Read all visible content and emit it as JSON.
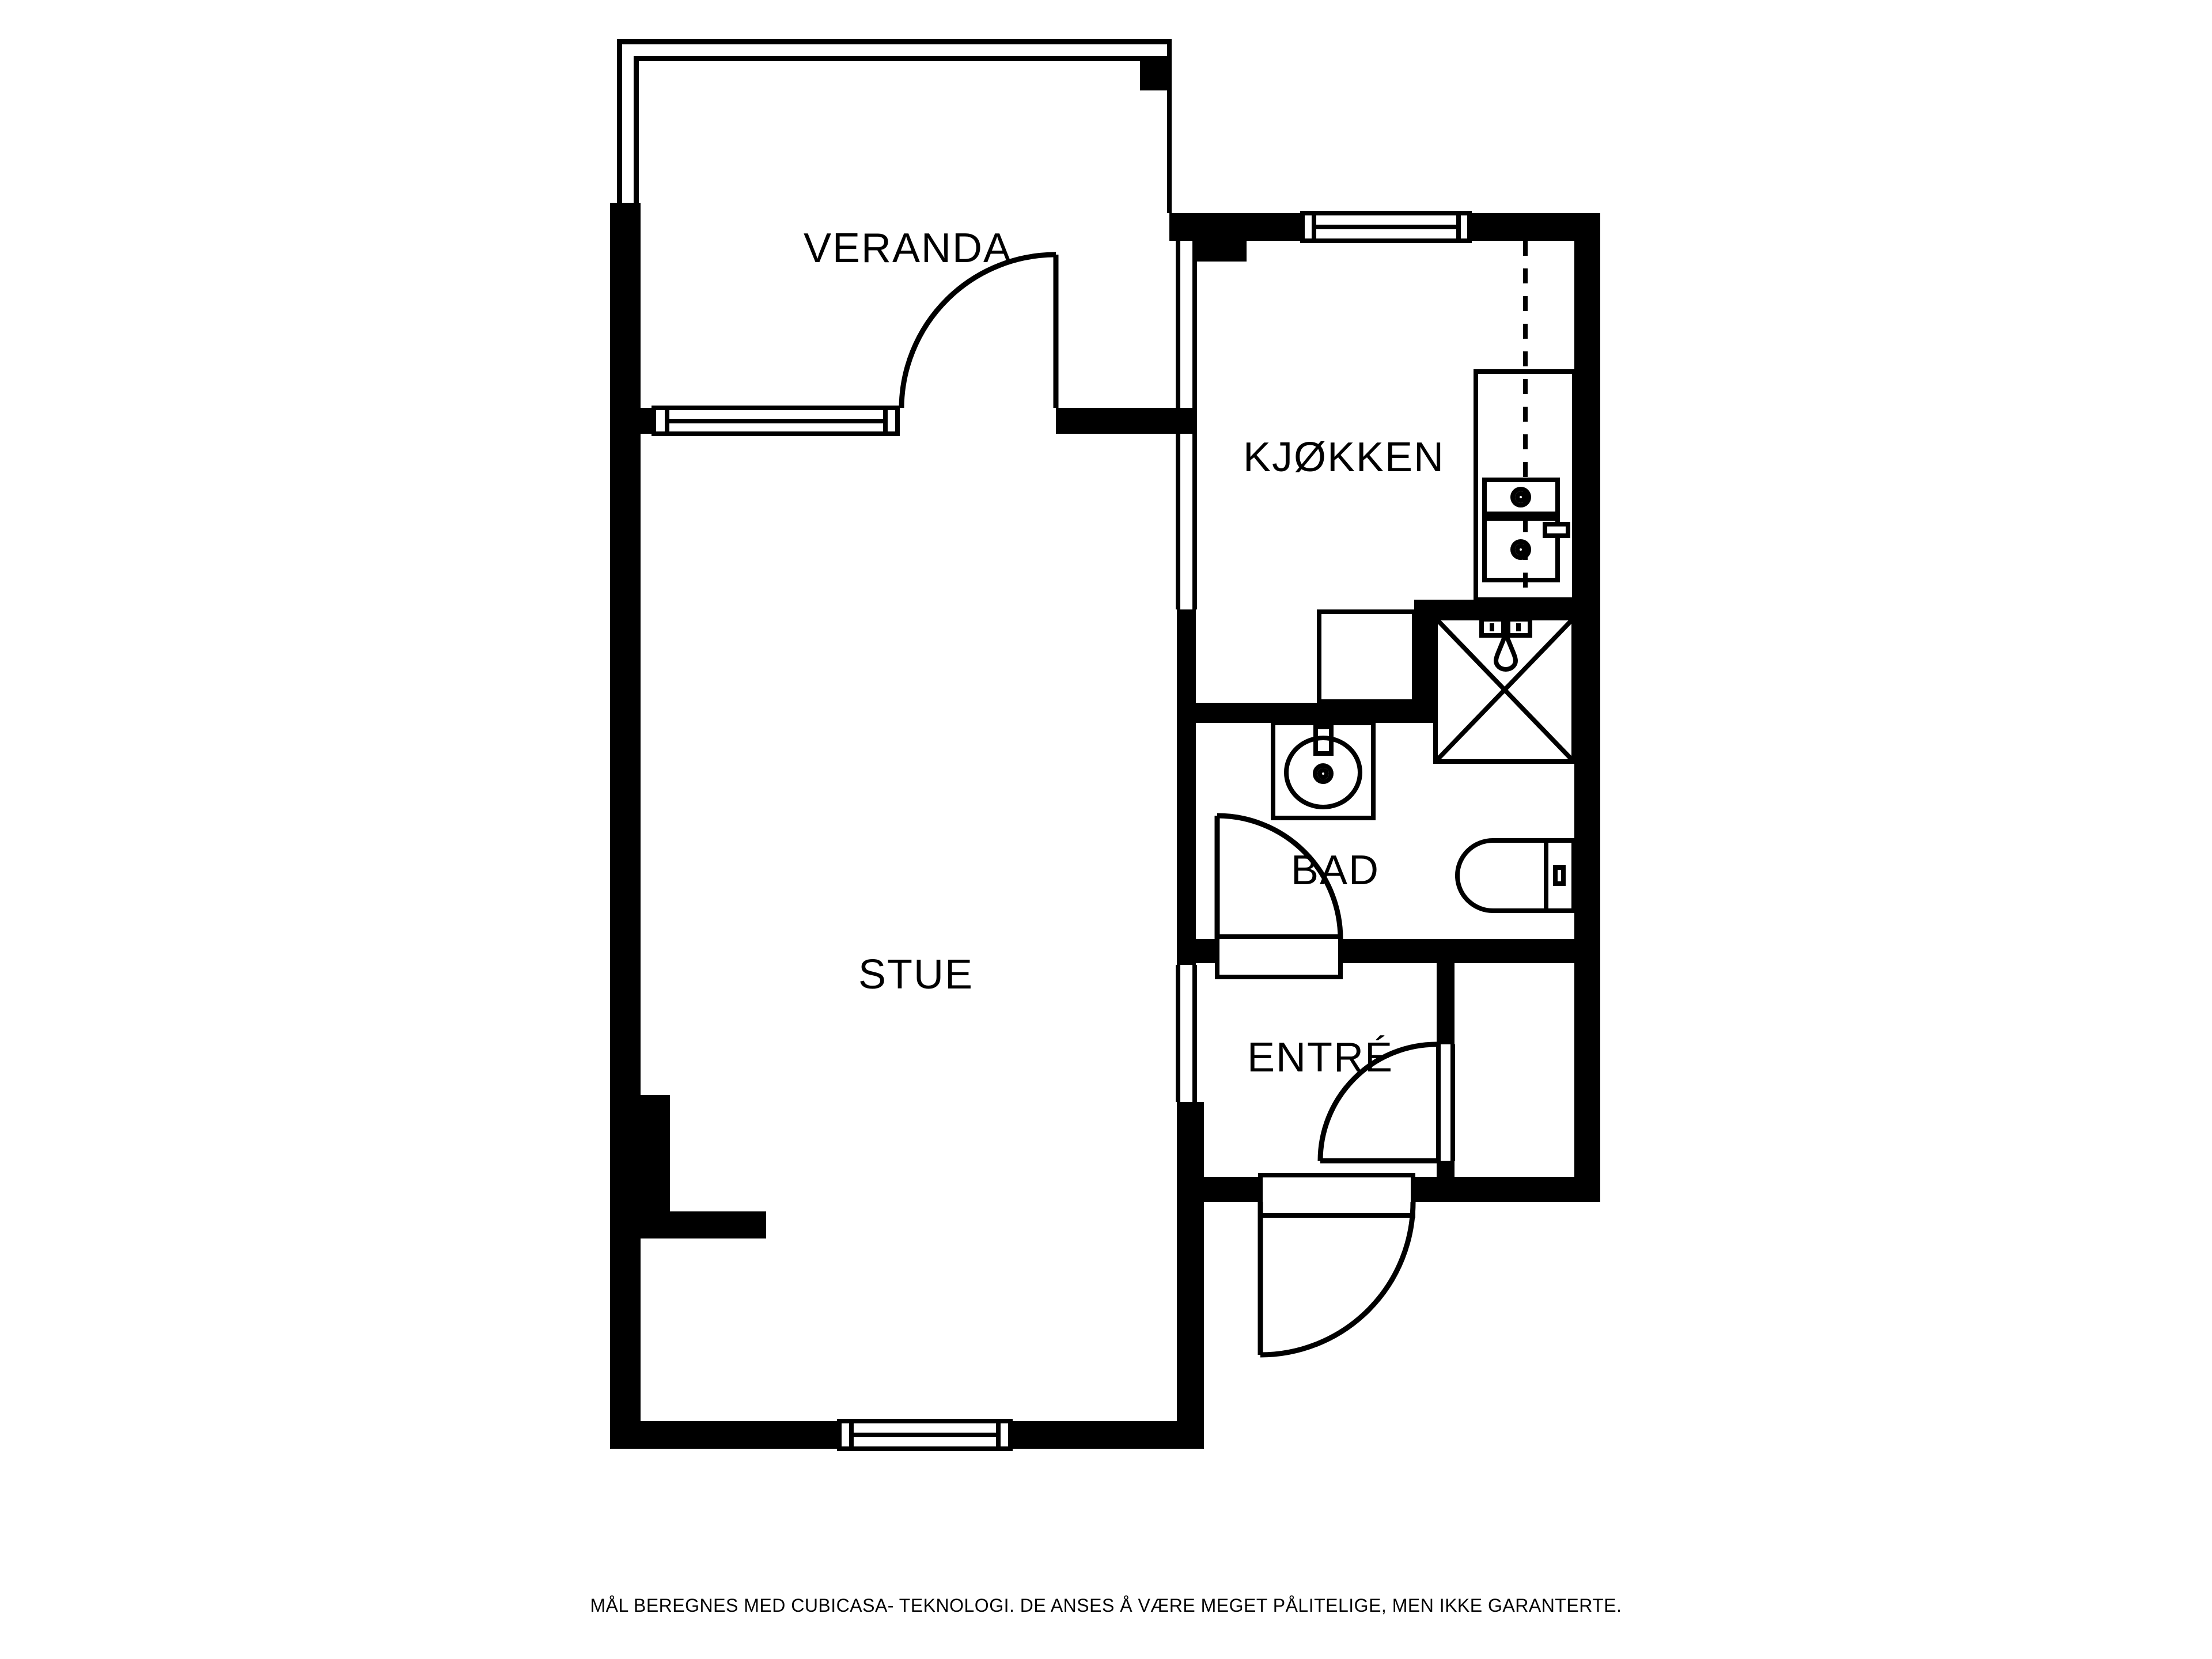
{
  "rooms": {
    "veranda": {
      "label": "VERANDA"
    },
    "kjokken": {
      "label": "KJØKKEN"
    },
    "stue": {
      "label": "STUE"
    },
    "bad": {
      "label": "BAD"
    },
    "entre": {
      "label": "ENTRÉ"
    }
  },
  "footer": {
    "disclaimer": "MÅL BEREGNES MED CUBICASA- TEKNOLOGI. DE ANSES Å VÆRE MEGET PÅLITELIGE, MEN IKKE GARANTERTE."
  },
  "colors": {
    "walls": "#000000",
    "background": "#ffffff"
  }
}
